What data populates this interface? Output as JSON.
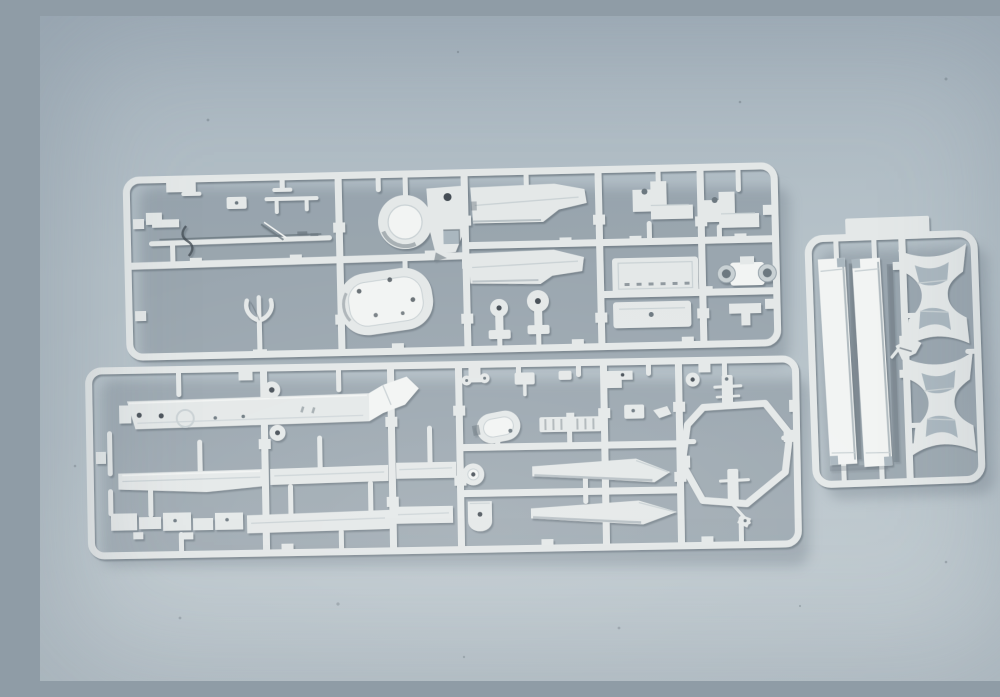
{
  "scene": {
    "type": "photograph",
    "description": "Photograph of light grey injection-moulded plastic model-kit sprues laid on a pale blue-grey surface: a long upper runner frame of small fittings, a long lower runner frame with flat deck and hull strip parts, and a small upright runner at the right holding two straight stand rails and two curved stand cradles.",
    "objects": [
      {
        "id": "sprue-a",
        "label": "upper parts sprue",
        "description": "Long horizontal runner frame holding small brackets, a thin rod, a three-prong fork, an oval deck piece, a round winch drum with bracket, stepped deck strips, two seat-shaped brackets, ribbed panels and a twin-wheel axle part"
      },
      {
        "id": "sprue-b",
        "label": "lower parts sprue",
        "description": "Long horizontal runner frame holding a flat perforated deck plate, long narrow hull strips, an oval funnel cap, a ribbed grate, a ring, a U-shaped piece, two angled wedge blades, a hexagonal runner loop and two small mast pieces"
      },
      {
        "id": "sprue-c",
        "label": "stand sprue",
        "description": "Small upright runner frame with a wide tab at the top, two long straight display-stand rails and two curved cradle brackets"
      }
    ],
    "material": "white-grey polystyrene plastic",
    "surface": "plain pale blue-grey backdrop"
  },
  "colors": {
    "background_top": "#a9b6c0",
    "background_mid": "#b6c2c9",
    "background_bottom": "#c3cdd2",
    "plastic": "#e4e8e8",
    "plastic_highlight": "#f2f4f3",
    "plastic_mid": "#c9d1d4",
    "plastic_shadow": "#96a2aa",
    "crevice": "#6c7880",
    "dark_detail": "#454e55",
    "hole": "#aab7bf",
    "cast_shadow": "rgba(96,110,121,0.32)"
  }
}
